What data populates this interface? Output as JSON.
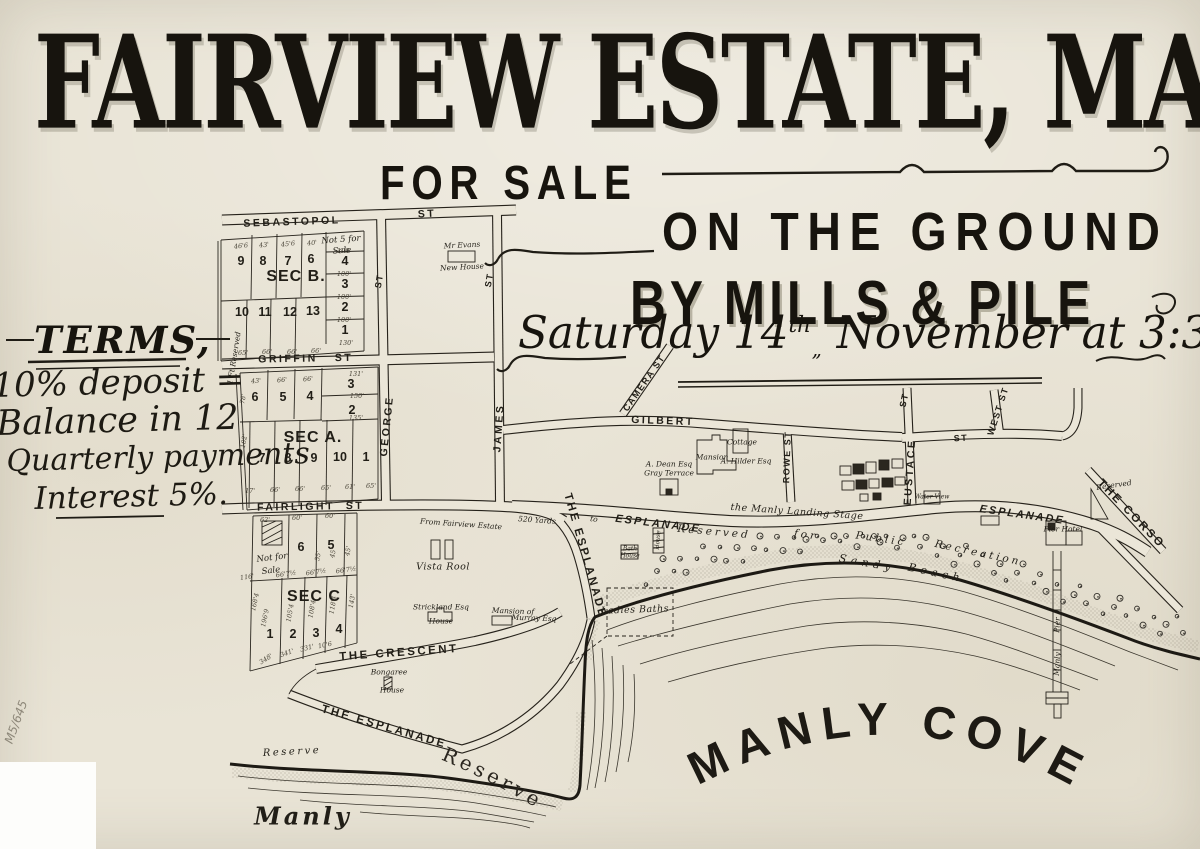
{
  "header": {
    "title": "FAIRVIEW ESTATE, MANLY",
    "for_sale": "FOR SALE",
    "on_the_ground": "ON THE GROUND",
    "by_line": "BY MILLS & PILE",
    "date_pre": "Saturday 14",
    "date_sup": "th",
    "date_sep": "„",
    "date_post": " November at 3:30."
  },
  "terms": {
    "heading": "TERMS,",
    "lines": [
      "10% deposit =",
      "Balance in 12",
      "Quarterly payments",
      "Interest 5%."
    ]
  },
  "map": {
    "cove_label": "MANLY COVE",
    "reserve_label": "Reserve",
    "labels": [
      {
        "t": "SEBASTOPOL",
        "x": 292,
        "y": 222,
        "r": -2,
        "c": "st1"
      },
      {
        "t": "ST",
        "x": 427,
        "y": 214,
        "r": -3,
        "c": "st1"
      },
      {
        "t": "GRIFFIN",
        "x": 288,
        "y": 359,
        "r": -1,
        "c": "st1"
      },
      {
        "t": "ST",
        "x": 344,
        "y": 358,
        "r": -1,
        "c": "st1"
      },
      {
        "t": "FAIRLIGHT",
        "x": 296,
        "y": 507,
        "r": -1,
        "c": "st1"
      },
      {
        "t": "ST",
        "x": 355,
        "y": 506,
        "r": -1,
        "c": "st1"
      },
      {
        "t": "GEORGE",
        "x": 387,
        "y": 426,
        "r": -84,
        "c": "st1"
      },
      {
        "t": "ST",
        "x": 379,
        "y": 281,
        "r": -80,
        "c": "st2"
      },
      {
        "t": "JAMES",
        "x": 499,
        "y": 428,
        "r": -86,
        "c": "st1"
      },
      {
        "t": "ST",
        "x": 489,
        "y": 280,
        "r": -80,
        "c": "st2"
      },
      {
        "t": "CAMERA ST",
        "x": 644,
        "y": 383,
        "r": -55,
        "c": "st2"
      },
      {
        "t": "GILBERT",
        "x": 663,
        "y": 421,
        "r": 2,
        "c": "st1"
      },
      {
        "t": "ROWE ST",
        "x": 787,
        "y": 457,
        "r": -88,
        "c": "st2"
      },
      {
        "t": "EUSTACE",
        "x": 910,
        "y": 472,
        "r": -86,
        "c": "st1"
      },
      {
        "t": "ST",
        "x": 904,
        "y": 400,
        "r": -78,
        "c": "st2"
      },
      {
        "t": "WEST ST",
        "x": 998,
        "y": 411,
        "r": -72,
        "c": "st2"
      },
      {
        "t": "ST",
        "x": 961,
        "y": 438,
        "r": -3,
        "c": "st2"
      },
      {
        "t": "ESPLANADE",
        "x": 658,
        "y": 524,
        "r": 7,
        "c": "espl"
      },
      {
        "t": "the Manly Landing Stage",
        "x": 797,
        "y": 512,
        "r": 4,
        "c": "it"
      },
      {
        "t": "ESPLANADE",
        "x": 1022,
        "y": 515,
        "r": 8,
        "c": "espl"
      },
      {
        "t": "THE ESPLANADE",
        "x": 585,
        "y": 556,
        "r": 74,
        "c": "espl2"
      },
      {
        "t": "THE CRESCENT",
        "x": 399,
        "y": 653,
        "r": -4,
        "c": "espl2"
      },
      {
        "t": "THE ESPLANADE",
        "x": 384,
        "y": 727,
        "r": 16,
        "c": "espl2"
      },
      {
        "t": "THE CORSO",
        "x": 1131,
        "y": 514,
        "r": 46,
        "c": "espl2"
      },
      {
        "t": "SEC B.",
        "x": 296,
        "y": 277,
        "r": 0,
        "c": "sec"
      },
      {
        "t": "SEC A.",
        "x": 313,
        "y": 438,
        "r": 0,
        "c": "sec"
      },
      {
        "t": "SEC C",
        "x": 314,
        "y": 597,
        "r": 0,
        "c": "sec"
      },
      {
        "t": "9",
        "x": 241,
        "y": 261,
        "r": 0,
        "c": "lot"
      },
      {
        "t": "8",
        "x": 263,
        "y": 261,
        "r": 0,
        "c": "lot"
      },
      {
        "t": "7",
        "x": 288,
        "y": 261,
        "r": 0,
        "c": "lot"
      },
      {
        "t": "6",
        "x": 311,
        "y": 259,
        "r": 0,
        "c": "lot"
      },
      {
        "t": "4",
        "x": 345,
        "y": 261,
        "r": 0,
        "c": "lot"
      },
      {
        "t": "3",
        "x": 345,
        "y": 284,
        "r": 0,
        "c": "lot"
      },
      {
        "t": "2",
        "x": 345,
        "y": 307,
        "r": 0,
        "c": "lot"
      },
      {
        "t": "1",
        "x": 345,
        "y": 330,
        "r": 0,
        "c": "lot"
      },
      {
        "t": "10",
        "x": 242,
        "y": 312,
        "r": 0,
        "c": "lot"
      },
      {
        "t": "11",
        "x": 265,
        "y": 312,
        "r": 0,
        "c": "lot"
      },
      {
        "t": "12",
        "x": 290,
        "y": 312,
        "r": 0,
        "c": "lot"
      },
      {
        "t": "13",
        "x": 313,
        "y": 311,
        "r": 0,
        "c": "lot"
      },
      {
        "t": "6",
        "x": 255,
        "y": 397,
        "r": 0,
        "c": "lot"
      },
      {
        "t": "5",
        "x": 283,
        "y": 397,
        "r": 0,
        "c": "lot"
      },
      {
        "t": "4",
        "x": 310,
        "y": 396,
        "r": 0,
        "c": "lot"
      },
      {
        "t": "3",
        "x": 351,
        "y": 384,
        "r": 0,
        "c": "lot"
      },
      {
        "t": "2",
        "x": 352,
        "y": 410,
        "r": 0,
        "c": "lot"
      },
      {
        "t": "7",
        "x": 262,
        "y": 458,
        "r": 0,
        "c": "lot"
      },
      {
        "t": "8",
        "x": 288,
        "y": 458,
        "r": 0,
        "c": "lot"
      },
      {
        "t": "9",
        "x": 314,
        "y": 458,
        "r": 0,
        "c": "lot"
      },
      {
        "t": "10",
        "x": 340,
        "y": 457,
        "r": 0,
        "c": "lot"
      },
      {
        "t": "1",
        "x": 366,
        "y": 457,
        "r": 0,
        "c": "lot"
      },
      {
        "t": "6",
        "x": 301,
        "y": 547,
        "r": 0,
        "c": "lot"
      },
      {
        "t": "5",
        "x": 331,
        "y": 545,
        "r": 0,
        "c": "lot"
      },
      {
        "t": "1",
        "x": 270,
        "y": 634,
        "r": 0,
        "c": "lot"
      },
      {
        "t": "2",
        "x": 293,
        "y": 634,
        "r": 0,
        "c": "lot"
      },
      {
        "t": "3",
        "x": 316,
        "y": 633,
        "r": 0,
        "c": "lot"
      },
      {
        "t": "4",
        "x": 339,
        "y": 629,
        "r": 0,
        "c": "lot"
      },
      {
        "t": "Not 5 for",
        "x": 341,
        "y": 240,
        "r": -4,
        "c": "itb"
      },
      {
        "t": "Sale",
        "x": 342,
        "y": 251,
        "r": -4,
        "c": "itb"
      },
      {
        "t": "Not for",
        "x": 272,
        "y": 558,
        "r": -7,
        "c": "itb"
      },
      {
        "t": "Sale",
        "x": 271,
        "y": 571,
        "r": -7,
        "c": "itb"
      },
      {
        "t": "Mr Evans",
        "x": 462,
        "y": 245,
        "r": -3,
        "c": "hx"
      },
      {
        "t": "New House",
        "x": 462,
        "y": 267,
        "r": -3,
        "c": "hx"
      },
      {
        "t": "Mansion",
        "x": 712,
        "y": 457,
        "r": 0,
        "c": "hx"
      },
      {
        "t": "Cottage",
        "x": 742,
        "y": 442,
        "r": 0,
        "c": "hx"
      },
      {
        "t": "A. Hilder Esq",
        "x": 746,
        "y": 461,
        "r": 0,
        "c": "hx"
      },
      {
        "t": "A. Dean Esq",
        "x": 669,
        "y": 464,
        "r": 0,
        "c": "hx"
      },
      {
        "t": "Gray Terrace",
        "x": 669,
        "y": 473,
        "r": 0,
        "c": "hx"
      },
      {
        "t": "Vista Rool",
        "x": 443,
        "y": 567,
        "r": 0,
        "c": "it"
      },
      {
        "t": "Strickland Esq",
        "x": 441,
        "y": 607,
        "r": 0,
        "c": "hx"
      },
      {
        "t": "House",
        "x": 441,
        "y": 621,
        "r": 0,
        "c": "hx"
      },
      {
        "t": "Mansion of",
        "x": 513,
        "y": 611,
        "r": 2,
        "c": "hx"
      },
      {
        "t": "Murray Esq",
        "x": 534,
        "y": 618,
        "r": 2,
        "c": "hx"
      },
      {
        "t": "Bongaree",
        "x": 389,
        "y": 672,
        "r": 0,
        "c": "hx"
      },
      {
        "t": "House",
        "x": 392,
        "y": 690,
        "r": 0,
        "c": "hx"
      },
      {
        "t": "Bath",
        "x": 630,
        "y": 549,
        "r": 0,
        "c": "hx2"
      },
      {
        "t": "House",
        "x": 630,
        "y": 556,
        "r": 0,
        "c": "hx2"
      },
      {
        "t": "House",
        "x": 658,
        "y": 540,
        "r": -85,
        "c": "hx2"
      },
      {
        "t": "Water View",
        "x": 932,
        "y": 497,
        "r": 0,
        "c": "hx2"
      },
      {
        "t": "Ladies Baths",
        "x": 635,
        "y": 610,
        "r": -2,
        "c": "it"
      },
      {
        "t": "Pier Hotel",
        "x": 1063,
        "y": 529,
        "r": 0,
        "c": "hx"
      },
      {
        "t": "Pier",
        "x": 1057,
        "y": 625,
        "r": -87,
        "c": "hx"
      },
      {
        "t": "Manly",
        "x": 1057,
        "y": 664,
        "r": -87,
        "c": "hx"
      },
      {
        "t": "Reserved",
        "x": 1114,
        "y": 485,
        "r": -8,
        "c": "hx"
      },
      {
        "t": "Reserve",
        "x": 292,
        "y": 752,
        "r": -3,
        "c": "it2"
      },
      {
        "t": "Manly",
        "x": 303,
        "y": 816,
        "r": 0,
        "c": "scr"
      },
      {
        "t": "From Fairview Estate",
        "x": 461,
        "y": 524,
        "r": 4,
        "c": "hx"
      },
      {
        "t": "520 Yards",
        "x": 537,
        "y": 520,
        "r": 4,
        "c": "hx"
      },
      {
        "t": "to",
        "x": 594,
        "y": 519,
        "r": 8,
        "c": "hx"
      },
      {
        "t": "1 Ft Reserved",
        "x": 234,
        "y": 358,
        "r": -81,
        "c": "hx"
      },
      {
        "t": "Reserved",
        "x": 714,
        "y": 532,
        "r": 5,
        "c": "bw"
      },
      {
        "t": "for",
        "x": 806,
        "y": 535,
        "r": 8,
        "c": "bw"
      },
      {
        "t": "Public",
        "x": 881,
        "y": 539,
        "r": 8,
        "c": "bw"
      },
      {
        "t": "Recreation",
        "x": 978,
        "y": 553,
        "r": 12,
        "c": "bw"
      },
      {
        "t": "Sandy",
        "x": 867,
        "y": 563,
        "r": 10,
        "c": "bw2"
      },
      {
        "t": "Beach",
        "x": 936,
        "y": 573,
        "r": 12,
        "c": "bw2"
      },
      {
        "t": "M5/645",
        "x": 16,
        "y": 722,
        "r": -70,
        "c": "pencil"
      },
      {
        "t": "46'6",
        "x": 241,
        "y": 246,
        "r": -6,
        "c": "dim"
      },
      {
        "t": "43'",
        "x": 264,
        "y": 245,
        "r": -6,
        "c": "dim"
      },
      {
        "t": "45'6",
        "x": 288,
        "y": 244,
        "r": -6,
        "c": "dim"
      },
      {
        "t": "40'",
        "x": 312,
        "y": 243,
        "r": -6,
        "c": "dim"
      },
      {
        "t": "100'",
        "x": 344,
        "y": 251,
        "r": 0,
        "c": "dim"
      },
      {
        "t": "100'",
        "x": 344,
        "y": 274,
        "r": 0,
        "c": "dim"
      },
      {
        "t": "100'",
        "x": 344,
        "y": 297,
        "r": 0,
        "c": "dim"
      },
      {
        "t": "100'",
        "x": 344,
        "y": 320,
        "r": 0,
        "c": "dim"
      },
      {
        "t": "130'",
        "x": 346,
        "y": 343,
        "r": 0,
        "c": "dim"
      },
      {
        "t": "65'",
        "x": 243,
        "y": 353,
        "r": 0,
        "c": "dim"
      },
      {
        "t": "66'",
        "x": 267,
        "y": 352,
        "r": 0,
        "c": "dim"
      },
      {
        "t": "66'",
        "x": 292,
        "y": 352,
        "r": 0,
        "c": "dim"
      },
      {
        "t": "66'",
        "x": 316,
        "y": 351,
        "r": 0,
        "c": "dim"
      },
      {
        "t": "43'",
        "x": 256,
        "y": 381,
        "r": -4,
        "c": "dim"
      },
      {
        "t": "66'",
        "x": 282,
        "y": 380,
        "r": -4,
        "c": "dim"
      },
      {
        "t": "66'",
        "x": 308,
        "y": 379,
        "r": -4,
        "c": "dim"
      },
      {
        "t": "131'",
        "x": 356,
        "y": 374,
        "r": 0,
        "c": "dim"
      },
      {
        "t": "150'",
        "x": 357,
        "y": 396,
        "r": 0,
        "c": "dim"
      },
      {
        "t": "135'",
        "x": 356,
        "y": 418,
        "r": 0,
        "c": "dim"
      },
      {
        "t": "17'",
        "x": 250,
        "y": 491,
        "r": 0,
        "c": "dim"
      },
      {
        "t": "66'",
        "x": 275,
        "y": 490,
        "r": 0,
        "c": "dim"
      },
      {
        "t": "66'",
        "x": 300,
        "y": 489,
        "r": 0,
        "c": "dim"
      },
      {
        "t": "65'",
        "x": 326,
        "y": 488,
        "r": 0,
        "c": "dim"
      },
      {
        "t": "61'",
        "x": 350,
        "y": 487,
        "r": 0,
        "c": "dim"
      },
      {
        "t": "65'",
        "x": 371,
        "y": 486,
        "r": 0,
        "c": "dim"
      },
      {
        "t": "62'",
        "x": 265,
        "y": 520,
        "r": 0,
        "c": "dim"
      },
      {
        "t": "60'",
        "x": 297,
        "y": 518,
        "r": 0,
        "c": "dim"
      },
      {
        "t": "60'",
        "x": 330,
        "y": 516,
        "r": 0,
        "c": "dim"
      },
      {
        "t": "116'",
        "x": 247,
        "y": 577,
        "r": -8,
        "c": "dim"
      },
      {
        "t": "66'7½",
        "x": 286,
        "y": 574,
        "r": -8,
        "c": "dim"
      },
      {
        "t": "66'7½",
        "x": 316,
        "y": 572,
        "r": -8,
        "c": "dim"
      },
      {
        "t": "66'7½",
        "x": 346,
        "y": 570,
        "r": -8,
        "c": "dim"
      },
      {
        "t": "168'4",
        "x": 255,
        "y": 602,
        "r": -78,
        "c": "dim"
      },
      {
        "t": "196'9",
        "x": 265,
        "y": 618,
        "r": -78,
        "c": "dim"
      },
      {
        "t": "105'4",
        "x": 290,
        "y": 613,
        "r": -80,
        "c": "dim"
      },
      {
        "t": "108'4",
        "x": 312,
        "y": 609,
        "r": -80,
        "c": "dim"
      },
      {
        "t": "118'4",
        "x": 333,
        "y": 605,
        "r": -80,
        "c": "dim"
      },
      {
        "t": "143'",
        "x": 352,
        "y": 601,
        "r": -80,
        "c": "dim"
      },
      {
        "t": "348'",
        "x": 266,
        "y": 659,
        "r": -32,
        "c": "dim"
      },
      {
        "t": "341'",
        "x": 287,
        "y": 653,
        "r": -20,
        "c": "dim"
      },
      {
        "t": "331'",
        "x": 307,
        "y": 648,
        "r": -14,
        "c": "dim"
      },
      {
        "t": "10'6",
        "x": 325,
        "y": 645,
        "r": -12,
        "c": "dim"
      },
      {
        "t": "55'",
        "x": 318,
        "y": 556,
        "r": -80,
        "c": "dim"
      },
      {
        "t": "45'",
        "x": 333,
        "y": 553,
        "r": -80,
        "c": "dim"
      },
      {
        "t": "45'",
        "x": 348,
        "y": 551,
        "r": -80,
        "c": "dim"
      },
      {
        "t": "78'",
        "x": 243,
        "y": 399,
        "r": -80,
        "c": "dim"
      },
      {
        "t": "102'",
        "x": 244,
        "y": 441,
        "r": -80,
        "c": "dim"
      }
    ]
  }
}
